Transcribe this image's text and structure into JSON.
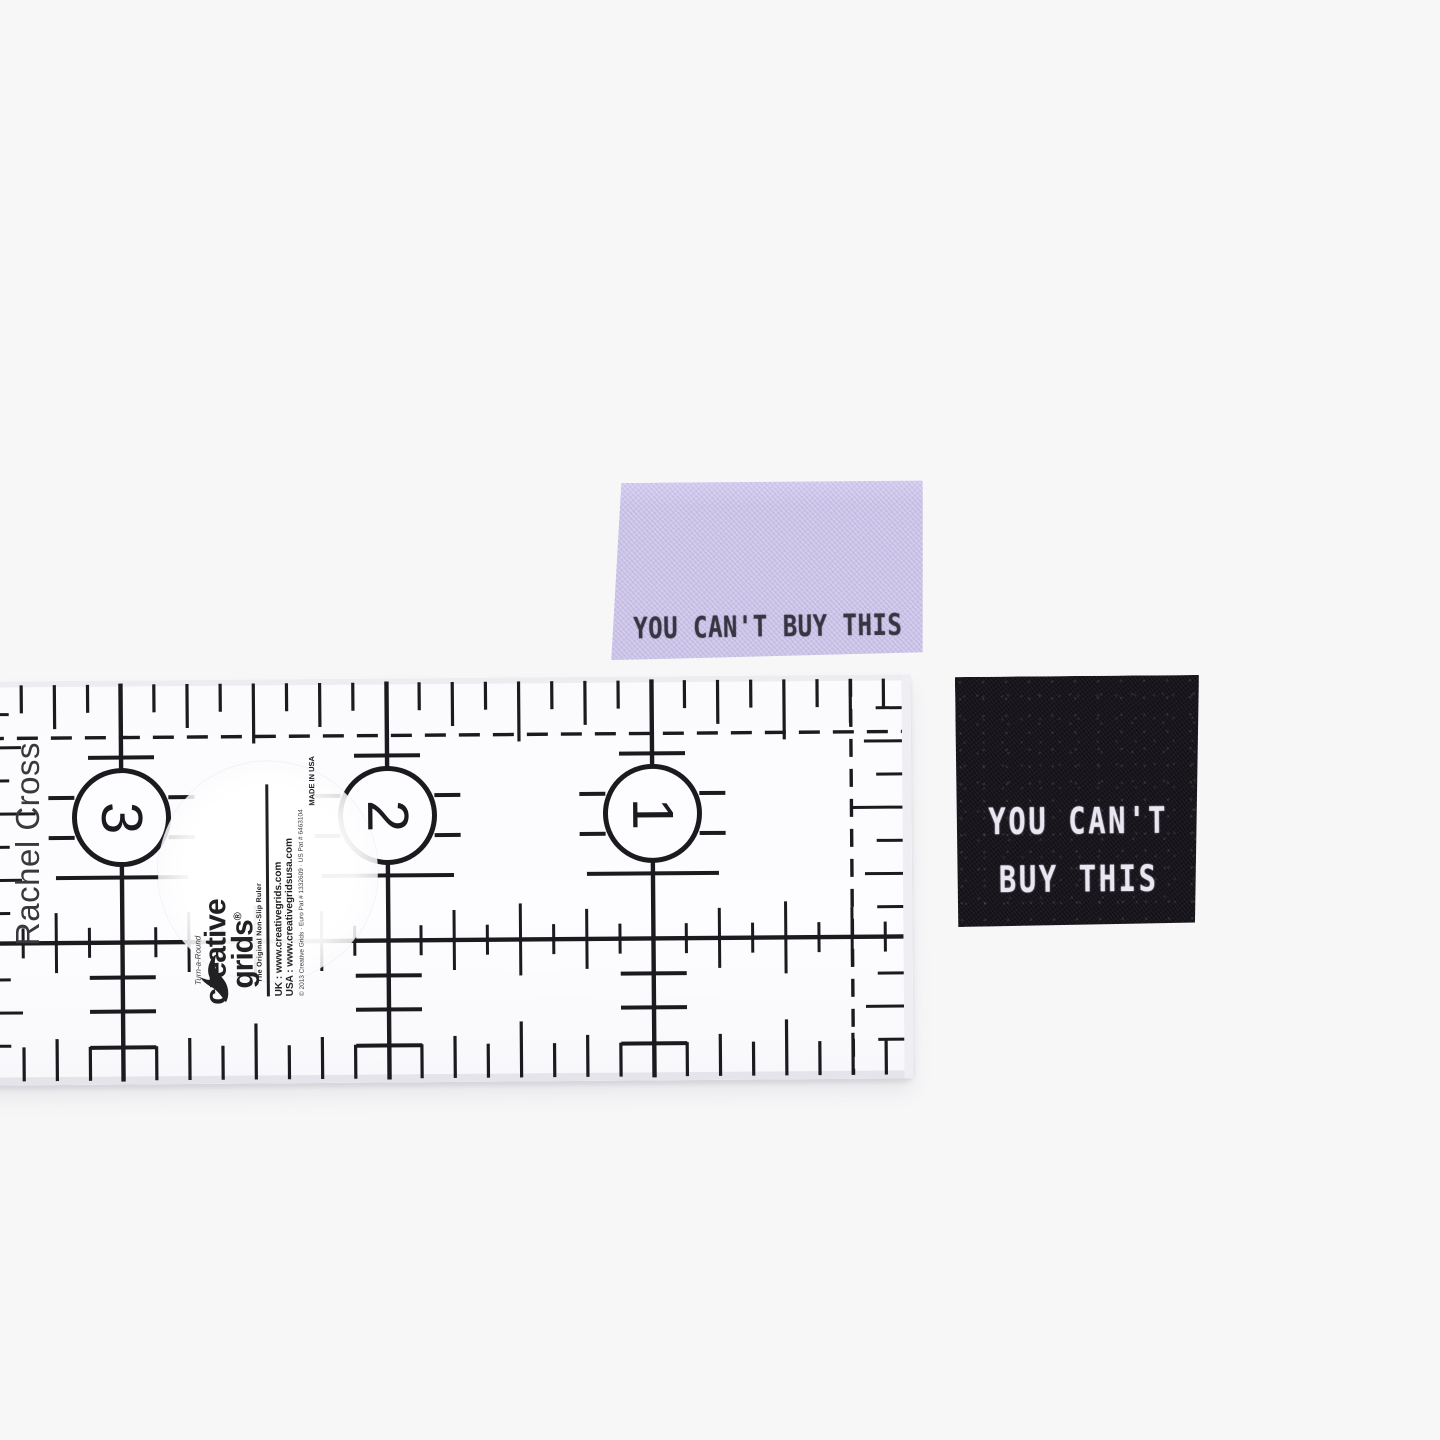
{
  "photo": {
    "background": "#f7f7f8",
    "description": "Two woven 'You Can't Buy This' sew-in clothing labels photographed beside a clear quilting ruler for scale"
  },
  "credit": {
    "text": "Rachel Cross"
  },
  "ruler": {
    "ink": "#1b1b1f",
    "numbers": [
      "3",
      "2",
      "1"
    ],
    "brand": {
      "script": "Turn-a-Round",
      "name_top": "creative",
      "name_bottom": "grids",
      "registered": "®",
      "tagline": "The Original Non-Slip Ruler",
      "url_uk": "UK : www.creativegrids.com",
      "url_usa": "USA : www.creativegridsusa.com",
      "fine_print": "© 2013 Creative Grids · Euro Pat # 1332609 · US Pat # 6463104",
      "made_in": "MADE IN USA"
    }
  },
  "labels": {
    "purple": {
      "text": "YOU CAN'T BUY THIS",
      "bg": "#cac1e7",
      "ink": "#383441",
      "shadow": "#ab9fd8"
    },
    "black": {
      "line1": "YOU CAN'T",
      "line2": "BUY THIS",
      "bg": "#17151b",
      "ink": "#eae7f3",
      "shadow": "#9c94b8"
    }
  }
}
